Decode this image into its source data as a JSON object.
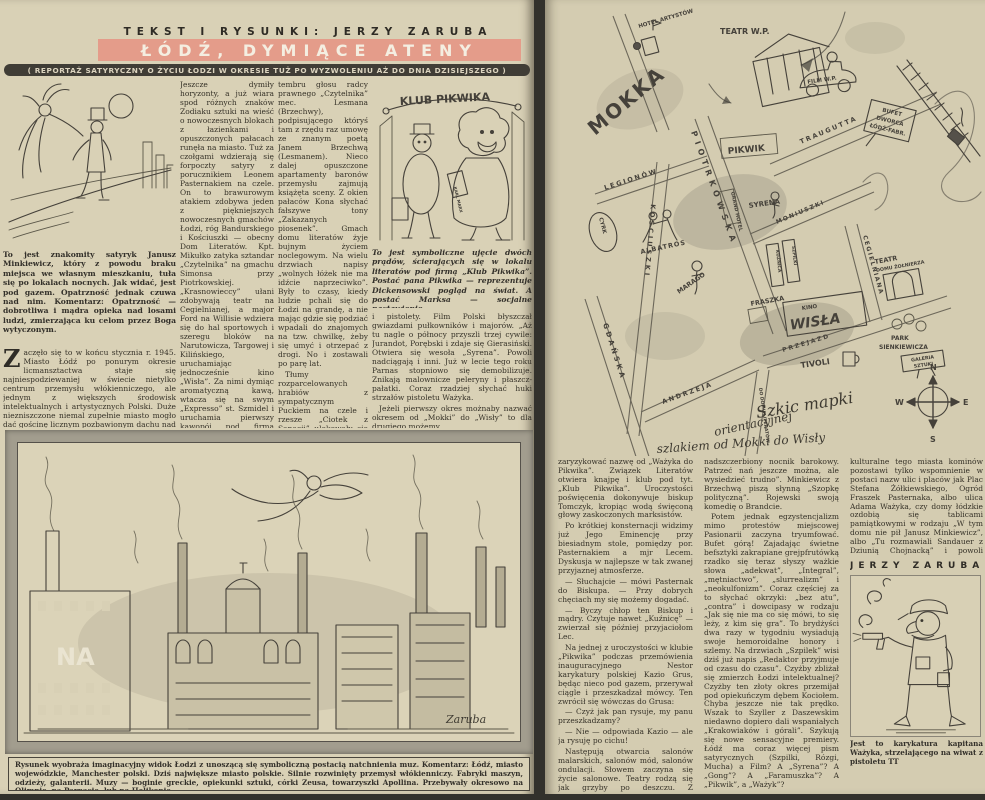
{
  "left_page": {
    "kicker": "TEKST I RYSUNKI: JERZY ZARUBA",
    "title": "ŁÓDŹ, DYMIĄCE ATENY",
    "subtitle": "( REPORTAŻ SATYRYCZNY O ŻYCIU ŁODZI W OKRESIE TUŻ PO WYZWOLENIU AŻ DO DNIA DZISIEJSZEGO )",
    "col1": {
      "caption": "To jest znakomity satyryk Janusz Minkiewicz, który z powodu braku miejsca we własnym mieszkaniu, tuła się po lokalach nocnych. Jak widać, jest pod gazem. Opatrzność jednak czuwa nad nim. Komentarz: Opatrzność — dobrotliwa i mądra opieka nad losami ludzi, zmierzająca ku celom przez Boga wytyczonym.",
      "dropcap": "Z",
      "body": "aczęło się to w końcu stycznia r. 1945. Miasto Łódź po ponurym okresie licmansztactwa staje się najniespodziewaniej w świecie nietylko centrum przemysłu włókienniczego, ale jednym z większych środowisk intelektualnych i artystycznych Polski. Duże niezniszczone niemal zupełnie miasto mogło dać gościnę licznym pozbawionym dachu nad głową muzom i ich adeptom. No i dało. Jeszcze huk armatni grał w uszach."
    },
    "col2": {
      "p1": "Jeszcze dymiły horyzonty, a już wiara spod różnych znaków Zodiaku sztuki na wieść o nowoczesnych blokach z łazienkami i opuszczonych pałacach runęła na miasto. Tuż za czołgami wdzierają się forpoczty satyry z porucznikiem Leonem Pasternakiem na czele. On to brawurowym atakiem zdobywa jeden z piękniejszych nowoczesnych gmachów Łodzi, róg Bandurskiego i Kościuszki — obecny Dom Literatów. Kpt. Mikułko zatyka sztandar „Czytelnika” na gmachu Simonsa przy Piotrkowskiej. „Krasnowieccy” ułani zdobywają teatr na Cegielnianej, a major Ford na Willisie wdziera się do hal sportowych i szeregu bloków na Narutowicza, Targowej i Kilińskiego, uruchamiając jednocześnie kino „Wisła”. Za nimi dymiąc aromatyczną kawą, wtacza się na swym „Expresso” st. Szmidel i uruchamia pierwszy kawopój pod firmą „Mokka”.",
      "p2": "Od tej chwili życie intelektualne Łodzi rozwijać się poczęło właśnie po linii od „Mokki” do „Wisły”. Gmach „Czytelnika” począł rozbrzmiewać charakterystycznym gwarem. Szum wodogrzmotów polskiego „Manchester Guardian” (Dziennik Łódzki) napróżno usiłuje zagłuszyć huki sierpów i młotów „Kuźnicy”. Trzecie piętro (prawa oficyna) zabezpieczywszy groźnymi napisami: „Nie wchodzić — miny” zajęły „Szpilki”. Zza tych to drzwi dochodzi wnikliwy i subtelny dźwięk piły satyrycznej zlekka posmarowanej wazeliną. Pierwsze piętro dygoce od tupania „Chłopów” ze „Wsi”, co nie przeszkadza jednak słyszeć uwodzicielskiego"
    },
    "col3": {
      "p1": "tembru głosu radcy prawnego „Czytelnika” mec. Lesmana (Brzechwy), podpisującego któryś tam z rzędu raz umowę ze znanym poetą Janem Brzechwą (Lesmanem). Nieco dalej opuszczone apartamenty baronów przemysłu zajmują książęta sceny. Z okien pałaców Kona słychać fałszywe tony „Zakazanych piosenek”. Gmach domu literatów żyje bujnym życiem noclegowym. Na wielu drzwiach napisy „wolnych łóżek nie ma idźcie naprzeciwko”. Były to czasy, kiedy ludzie pchali się do Łodzi na grandę, a nie mając gdzie się podziać wpadali do znajomych na tzw. chwilkę, żeby się umyć i otrzepać z drogi. No i zostawali po parę lat.",
      "p2": "Tłumy rozparcelowanych hrabiów z sympatycznym Puckiem na czele i rzesze „Ciotek z Sanacji” ulokowały się u Janusza Minkiewicza, który na skutek tego zmuszony był spędzać noce w specjalnie dla niego założonych lokalach nocnych „Ksantypa”, „Albatros”. No i w bufecie dworca Łódź-Fabryczna, uruchomionego w tym celu przez Ministerstwo Komunikacji. Tamto powstały jego słynne „Kazania i Skargi”. Któregoś dnia Minkiewicz był trzeźwy, ale we śnie. Co się stało, pytamy. Czuję się jak Gdynia — odpowiada. Co to znaczy? — Dwadzieścia kilometrów od Pucka.",
      "p3": "Okazało się, że hrabia Puck gdzieś wyjechał.",
      "p4": "W teatrze na Cegielnianej co wieczór odbywało się huczne „Wesele” Wyspiańskiego i „wszystkim się zdawało, że to gra ta muzyka i wojsko grało”. Łódź artystyczna nosiła jeszcze wtedy mundury"
    },
    "col4": {
      "p1": "i pistolety. Film Polski błyszczał gwiazdami pułkowników i majorów. „Aż tu nagle o północy przyszli trzej cywile: Jurandot, Porębski i zdaje się Gierasiński. Otwiera się wesoła „Syrena”. Powoli nadciągają i inni. Już w lecie tego roku Parnas stopniowo się demobilizuje. Znikają malownicze peleryny i płaszcz-pałatki. Coraz rzadziej słychać huki strzałów pistoletu Ważyka.",
      "p2": "Jeżeli pierwszy okres możnaby nazwać okresem od „Mokki” do „Wisły” to dla drugiego możemy"
    },
    "pikwik": {
      "sign": "KLUB PIKWIKA",
      "book": "KARL MARX",
      "caption": "To jest symboliczne ujęcie dwóch prądów, ścierających się w lokalu literatów pod firmą „Klub Pikwika”. Postać pana Pikwika — reprezentuje Dickensowski pogląd na świat. A postać Marksa — socjalne nastawienie."
    },
    "panorama": {
      "na": "NA",
      "signature": "Zaruba",
      "caption": "Rysunek wyobraża imaginacyjny widok Łodzi z unoszącą się symboliczną postacią natchnienia muz. Komentarz: Łódź, miasto wojewódzkie, Manchester polski. Dziś największe miasto polskie. Silnie rozwinięty przemysł włókienniczy. Fabryki maszyn, odzieży, galanterii. Muzy — boginie greckie, opiekunki sztuki, córki Zeusa, towarzyszki Apollina. Przebywały okresowo na Olimpie, na Parnasie, lub na Helikonie."
    }
  },
  "right_page": {
    "map": {
      "labels": {
        "mokka": "MOKKA",
        "hotel_artystow": "HOTEL ARTYSTÓW",
        "teatr_wp": "TEATR W.P.",
        "film_wp": "FILM W.P.",
        "bufet1": "BUFET",
        "bufet2": "DWORCA",
        "bufet3": "ŁÓDŹ-FABR.",
        "pikwik": "PIKWIK",
        "traugutta": "TRAUGUTTA",
        "moniuszki": "MONIUSZKI",
        "piotrkowska": "PIOTRKOWSKA",
        "cegielniana": "CEGIELNIANA",
        "przejazd": "PRZEJAZD",
        "legionow": "LEGIONÓW",
        "kosciuszki": "KOŚCIUSZKI",
        "gdanska": "GDAŃSKA",
        "andrzeja": "ANDRZEJA",
        "grand_hotel": "GRAND HOTEL",
        "syrena": "SYRENA",
        "albatros": "ALBATROS",
        "cyrk": "CYRK",
        "marago": "MARAGO",
        "kuznica": "KUŹNICA",
        "szpilki": "SZPILKI",
        "fraszka": "FRASZKA",
        "kino": "KINO",
        "wisla": "WISŁA",
        "tivoli": "TIVOLI",
        "teatr_dz1": "TEATR",
        "teatr_dz2": "DOMU ŻOŁNIERZA",
        "park1": "PARK",
        "park2": "SIENKIEWICZA",
        "galeria1": "GALERIA",
        "galeria2": "SZTUKI",
        "do_domu": "DO DOMU LITERATÓW"
      },
      "compass": {
        "n": "N",
        "e": "E",
        "s": "S",
        "w": "W"
      },
      "caption": {
        "l1": "Szkic mapki",
        "l2": "orientacyjnej",
        "l3": "szlakiem od Mokki do Wisły"
      }
    },
    "colA": {
      "p1": "zaryzykować nazwę od „Ważyka do Pikwika”. Związek Literatów otwiera knajpę i klub pod tyt. „Klub Pikwika”. Uroczystości poświęcenia dokonywuje biskup Tomczyk, kropiąc wodą święconą głowy zaskoczonych marksistów.",
      "p2": "Po krótkiej konsternacji widzimy już Jego Eminencję przy biesiadnym stole, pomiędzy por. Pasternakiem a mjr Lecem. Dyskusja w najlepsze w tak zwanej przyjaznej atmosferze.",
      "p3": "— Słuchajcie — mówi Pasternak do Biskupa. — Przy dobrych chęciach my się możemy dogadać.",
      "p4": "— Byczy chłop ten Biskup i mądry. Czytuje nawet „Kuźnicę” — zwierzał się później przyjaciołom Lec.",
      "p5": "Na jednej z uroczystości w klubie „Pikwika” podczas przemówienia inauguracyjnego Nestor karykatury polskiej Kazio Grus, będąc nieco pod gazem, przerywał ciągle i przeszkadzał mówcy. Ten zwrócił się wówczas do Grusa:",
      "p6": "— Czyż jak pan rysuje, my panu przeszkadzamy?",
      "p7": "— Nie — odpowiada Kazio — ale ja rysuję po cichu!",
      "p8": "Następują otwarcia salonów malarskich, salonów mód, salonów ondulacji. Słowem zaczyna się życie salonowe. Teatry rodzą się jak grzyby po deszczu. Z repertuarem jest nieco gorzej. Można byłoby do sztuk tych zastosować powiedzonko Słonimskiego, że „przypominają"
    },
    "colB": {
      "p1": "nadszczerbiony nocnik barokowy. Patrzeć nań jeszcze można, ale wysiedzieć trudno”. Minkiewicz z Brzechwą piszą słynną „Szopkę polityczną”. Rojewski swoją komedię o Brandcie.",
      "p2": "Potem jednak egzystencjalizm mimo protestów miejscowej Pasionarii zaczyna tryumfować. Bufet górą! Zajadając świetne befsztyki zakrapiane grejpfrutówką rzadko się teraz słyszy ważkie słowa „adekwat”, „Integral”, „mętniactwo”, „slurrealizm” i „neokulfonizm”. Coraz częściej za to słychać okrzyki: „bez atu”, „contra” i dowcipasy w rodzaju „Jak się nie ma co się mówi, to się leży, z kim się gra”. To brydżyści dwa razy w tygodniu wysiadują swoje hemoroidalne honory i szlemy. Na drzwiach „Szpilek” wisi dziś już napis „Redaktor przyjmuje od czasu do czasu”. Czyżby zbliżał się zmierzch Łodzi intelektualnej? Czyżby ten złoty okres przemijał pod opiekuńczym dębem Kociołem. Chyba jeszcze nie tak prędko. Wszak to Szyller z Daszewskim niedawno dopiero dali wspaniałych „Krakowiaków i górali”. Szykują się nowe sensacyjne premiery. Łódź ma coraz więcej pism satyrycznych (Szpilki, Rózgi, Mucha) a Film? A „Syrena”? A „Gong”? A „Faramuszka”? A „Pikwik”, a „Ważyk”?",
      "p3": "Czy bliskość odbudowującej się stolicy stanie się powodem, że Łódź utraci palmę „priorytety” bogate w latach 1945-1946 życie"
    },
    "colC": {
      "p1": "kulturalne tego miasta kominów pozostawi tylko wspomnienie w postaci nazw ulic i placów jak Plac Stefana Żółkiewskiego, Ogród Fraszek Pasternaka, albo ulica Adama Ważyka, czy domy łódzkie ozdobią się tablicami pamiątkowymi w rodzaju „W tym domu nie pił Janusz Minkiewicz”, albo „Tu rozmawiali Sandauer z Dziunią Chojnacką” i powoli anegdoty przejdą w legendę, a legendy w brechty. Kto wie?"
    },
    "signature": "JERZY ZARUBA",
    "cartoon_caption": "Jest to karykatura kapitana Ważyka, strzelającego na wiwat z pistoletu TT"
  }
}
